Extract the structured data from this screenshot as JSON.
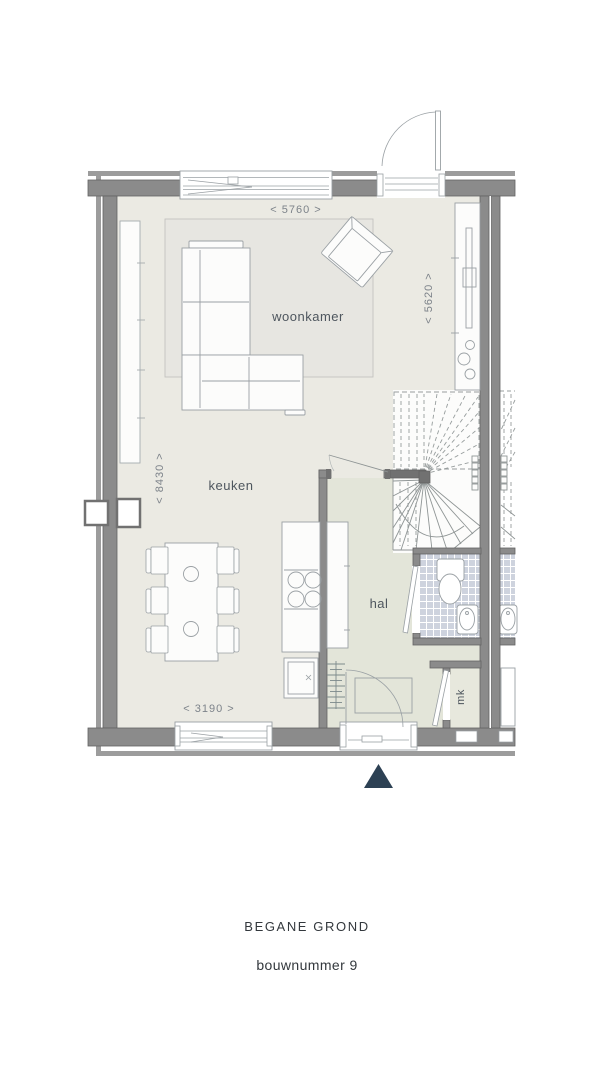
{
  "plan": {
    "rooms": {
      "living": "woonkamer",
      "kitchen": "keuken",
      "hall": "hal",
      "meter_closet": "mk"
    },
    "dimensions": {
      "top_width": "< 5760 >",
      "right_height": "< 5620 >",
      "left_height": "< 8430 >",
      "bottom_width": "< 3190 >"
    }
  },
  "caption": {
    "title": "BEGANE GROND",
    "subtitle": "bouwnummer 9"
  },
  "colors": {
    "wall": "#8b8b8b",
    "wall_dark": "#636363",
    "wall_stub": "#717171",
    "outer_leaf": "#9c9c9c",
    "floor": "#ebeae3",
    "floor_hall": "#e3e5d9",
    "floor_mk": "#e7e8dd",
    "rug": "#e7e6e1",
    "tile": "#ced3de",
    "white": "#fcfcfb",
    "line": "#9aa0a4",
    "dash": "#979d9d",
    "text_dim": "#7d838a",
    "text_room": "#4e565e",
    "text_caption": "#33383d",
    "north": "#2d4154"
  }
}
